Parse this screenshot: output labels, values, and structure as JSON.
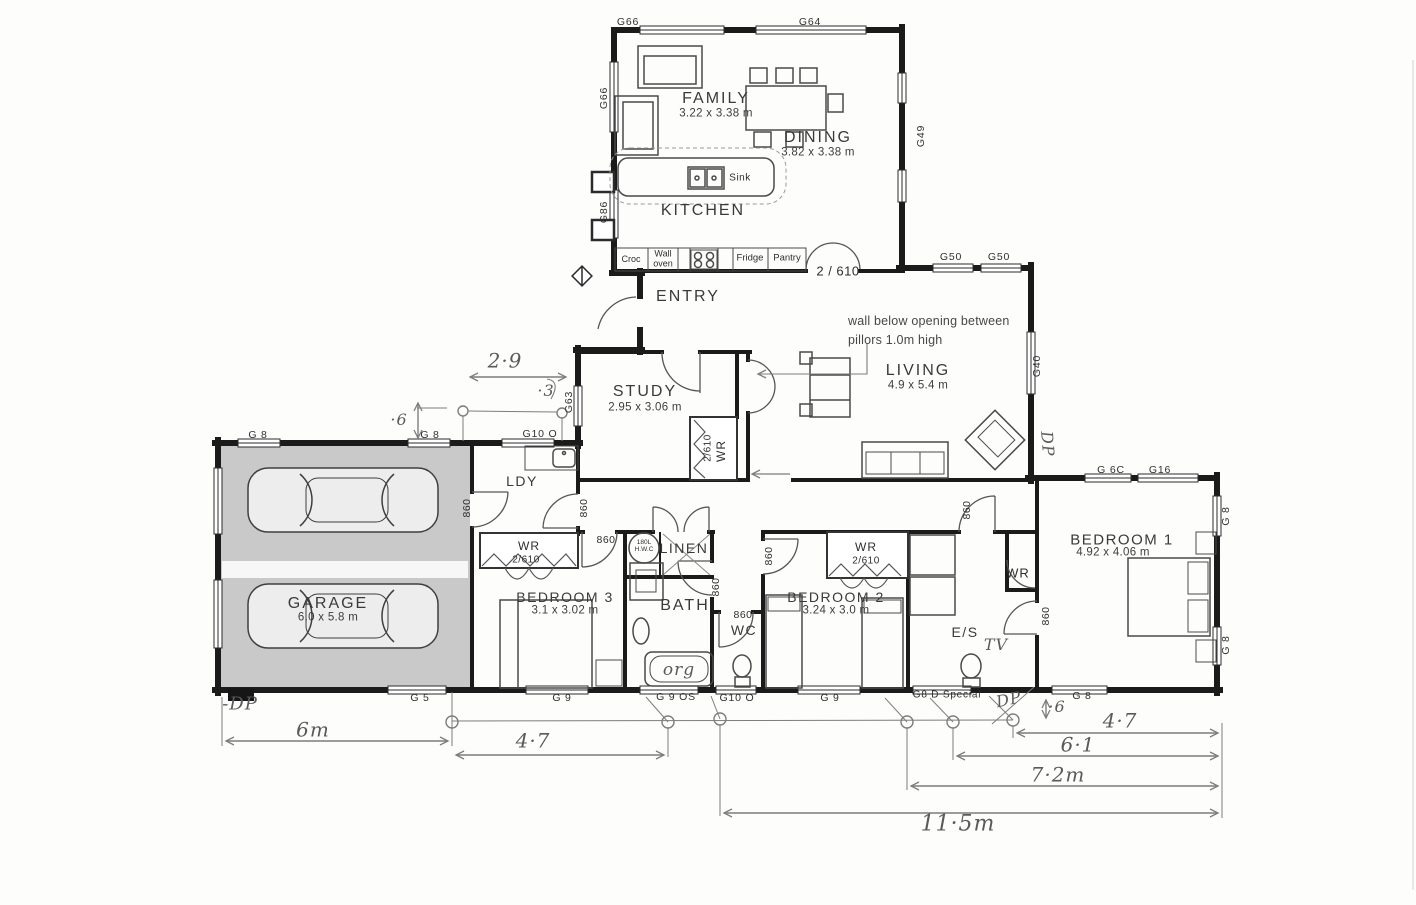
{
  "plan": {
    "rooms": {
      "family": {
        "name": "FAMILY",
        "dims": "3.22 x 3.38 m"
      },
      "dining": {
        "name": "DINING",
        "dims": "3.82 x 3.38 m"
      },
      "kitchen": {
        "name": "KITCHEN"
      },
      "entry": {
        "name": "ENTRY"
      },
      "study": {
        "name": "STUDY",
        "dims": "2.95 x 3.06 m"
      },
      "living": {
        "name": "LIVING",
        "dims": "4.9 x 5.4 m"
      },
      "garage": {
        "name": "GARAGE",
        "dims": "6.0 x 5.8 m"
      },
      "laundry": {
        "name": "LDY"
      },
      "wardrobe": {
        "name": "WR",
        "size": "2/610"
      },
      "linen": {
        "name": "LINEN"
      },
      "bath": {
        "name": "BATH"
      },
      "wc": {
        "name": "WC"
      },
      "bedroom3": {
        "name": "BEDROOM 3",
        "dims": "3.1 x 3.02 m"
      },
      "bedroom2": {
        "name": "BEDROOM 2",
        "dims": "3.24 x 3.0 m"
      },
      "bedroom1": {
        "name": "BEDROOM 1",
        "dims": "4.92 x 4.06 m"
      },
      "ensuite": {
        "name": "E/S"
      }
    },
    "kitchen_fixtures": {
      "croc": "Croc",
      "wall_oven": "Wall\noven",
      "fridge": "Fridge",
      "pantry": "Pantry",
      "sink": "Sink"
    },
    "doors": {
      "d860": "860",
      "d2610": "2 / 610",
      "d2610c": "2/610"
    },
    "fixtures": {
      "hwc": "180L\nH.W.C"
    },
    "windows": {
      "g66": "G66",
      "g64": "G64",
      "g86": "G86",
      "g49": "G49",
      "g50": "G50",
      "g40": "G40",
      "g63": "G63",
      "g8": "G 8",
      "g6c": "G 6C",
      "g16": "G16",
      "g5": "G 5",
      "g9": "G 9",
      "g9os": "G 9 OS",
      "g10o": "G10 O",
      "g8d": "G8 D Special"
    },
    "notes": {
      "wall_note": "wall below opening between\npillors 1.0m high",
      "tv": "TV",
      "org": "org",
      "dp": "DP",
      "minus_dp": "-DP"
    },
    "dimensions": {
      "d29": "2·9",
      "d03": "·3",
      "d06": "·6",
      "d6m": "6m",
      "d47": "4·7",
      "d61": "6·1",
      "d72m": "7·2m",
      "d115m": "11·5m"
    }
  }
}
